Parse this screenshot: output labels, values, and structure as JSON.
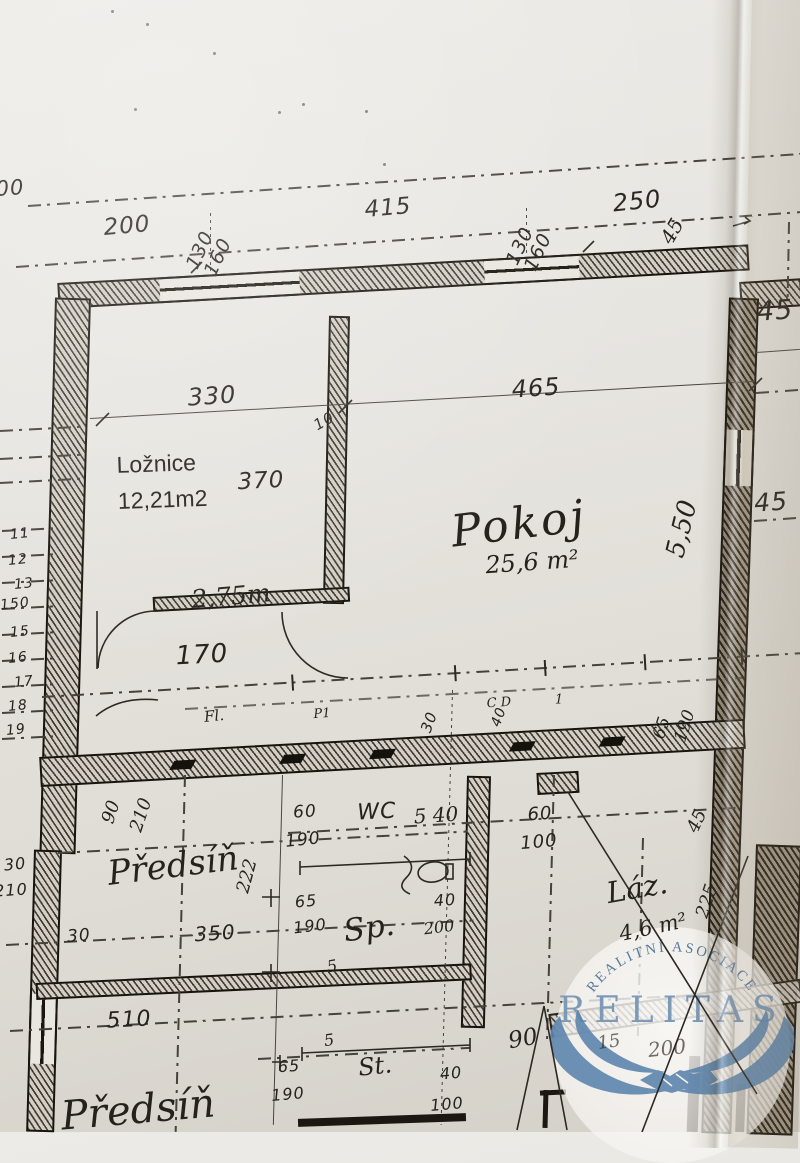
{
  "rooms": {
    "loznice": {
      "name": "Ložnice",
      "area": "12,21m2"
    },
    "pokoj": {
      "name": "Pokoj",
      "area": "25,6 m²"
    },
    "predsin": {
      "name": "Předsíň"
    },
    "wc": {
      "name": "WC"
    },
    "lazen": {
      "name": "Láz.",
      "area": "4,6 m²"
    },
    "spiz": {
      "name": "Sp."
    },
    "stoupacka": {
      "name": "St."
    }
  },
  "watermark": {
    "arc_text": "REALITNÍ ASOCIACE",
    "brand": "RELITAS",
    "logo": "handshake-wings-icon",
    "brand_color": "#7796b5",
    "logo_color": "#5d86ae"
  },
  "annotations": [
    {
      "t": "00",
      "x": 10,
      "y": 188,
      "s": 21,
      "r": -4,
      "f": "h"
    },
    {
      "t": "200",
      "x": 127,
      "y": 226,
      "s": 23,
      "r": -5,
      "f": "h"
    },
    {
      "t": "415",
      "x": 388,
      "y": 208,
      "s": 23,
      "r": -5,
      "f": "h"
    },
    {
      "t": "250",
      "x": 637,
      "y": 201,
      "s": 24,
      "r": -6,
      "f": "h"
    },
    {
      "t": "130",
      "x": 200,
      "y": 250,
      "s": 19,
      "r": -65,
      "f": "h"
    },
    {
      "t": "160",
      "x": 218,
      "y": 257,
      "s": 19,
      "r": -65,
      "f": "h"
    },
    {
      "t": "130",
      "x": 520,
      "y": 246,
      "s": 19,
      "r": -65,
      "f": "h"
    },
    {
      "t": "160",
      "x": 538,
      "y": 252,
      "s": 19,
      "r": -65,
      "f": "h"
    },
    {
      "t": "45",
      "x": 672,
      "y": 231,
      "s": 20,
      "r": -60,
      "f": "c"
    },
    {
      "t": "45",
      "x": 775,
      "y": 311,
      "s": 27,
      "r": -4,
      "f": "h"
    },
    {
      "t": "45",
      "x": 771,
      "y": 502,
      "s": 25,
      "r": -4,
      "f": "h"
    },
    {
      "t": "330",
      "x": 212,
      "y": 396,
      "s": 24,
      "r": -4,
      "f": "h"
    },
    {
      "t": "465",
      "x": 536,
      "y": 388,
      "s": 24,
      "r": -4,
      "f": "h"
    },
    {
      "t": "10",
      "x": 324,
      "y": 421,
      "s": 15,
      "r": -30,
      "f": "h"
    },
    {
      "t": "370",
      "x": 261,
      "y": 481,
      "s": 23,
      "r": -3,
      "f": "h"
    },
    {
      "t": "5,50",
      "x": 682,
      "y": 529,
      "s": 26,
      "r": -76,
      "f": "c"
    },
    {
      "t": "2,75m",
      "x": 231,
      "y": 596,
      "s": 25,
      "r": -5,
      "f": "c"
    },
    {
      "t": "170",
      "x": 202,
      "y": 655,
      "s": 26,
      "r": -3,
      "f": "h"
    },
    {
      "t": "Fl.",
      "x": 214,
      "y": 716,
      "s": 15,
      "r": -6,
      "f": "c"
    },
    {
      "t": "P1",
      "x": 322,
      "y": 714,
      "s": 13,
      "r": -4,
      "f": "c"
    },
    {
      "t": "C D",
      "x": 499,
      "y": 703,
      "s": 13,
      "r": -4,
      "f": "c"
    },
    {
      "t": "1",
      "x": 559,
      "y": 700,
      "s": 13,
      "r": 0,
      "f": "c"
    },
    {
      "t": "30",
      "x": 429,
      "y": 722,
      "s": 15,
      "r": -70,
      "f": "h"
    },
    {
      "t": "40",
      "x": 499,
      "y": 717,
      "s": 14,
      "r": -70,
      "f": "h"
    },
    {
      "t": "5 40",
      "x": 436,
      "y": 815,
      "s": 20,
      "r": -4,
      "f": "c"
    },
    {
      "t": "60",
      "x": 305,
      "y": 812,
      "s": 17,
      "r": -4,
      "f": "h"
    },
    {
      "t": "190",
      "x": 303,
      "y": 840,
      "s": 17,
      "r": -6,
      "f": "h"
    },
    {
      "t": "60",
      "x": 540,
      "y": 814,
      "s": 18,
      "r": -4,
      "f": "h"
    },
    {
      "t": "100",
      "x": 539,
      "y": 842,
      "s": 18,
      "r": -5,
      "f": "h"
    },
    {
      "t": "90",
      "x": 111,
      "y": 812,
      "s": 18,
      "r": -72,
      "f": "c"
    },
    {
      "t": "210",
      "x": 141,
      "y": 815,
      "s": 18,
      "r": -72,
      "f": "c"
    },
    {
      "t": "222",
      "x": 247,
      "y": 876,
      "s": 18,
      "r": -75,
      "f": "c"
    },
    {
      "t": "30",
      "x": 15,
      "y": 864,
      "s": 16,
      "r": -6,
      "f": "h"
    },
    {
      "t": "210",
      "x": 11,
      "y": 890,
      "s": 16,
      "r": -4,
      "f": "h"
    },
    {
      "t": "30",
      "x": 79,
      "y": 936,
      "s": 17,
      "r": -5,
      "f": "h"
    },
    {
      "t": "350",
      "x": 215,
      "y": 933,
      "s": 20,
      "r": -4,
      "f": "h"
    },
    {
      "t": "510",
      "x": 129,
      "y": 1020,
      "s": 22,
      "r": -3,
      "f": "h"
    },
    {
      "t": "5",
      "x": 332,
      "y": 966,
      "s": 16,
      "r": -10,
      "f": "c"
    },
    {
      "t": "5",
      "x": 329,
      "y": 1040,
      "s": 16,
      "r": -8,
      "f": "c"
    },
    {
      "t": "90",
      "x": 523,
      "y": 1039,
      "s": 23,
      "r": -10,
      "f": "c"
    },
    {
      "t": "65",
      "x": 306,
      "y": 901,
      "s": 16,
      "r": -5,
      "f": "h"
    },
    {
      "t": "190",
      "x": 310,
      "y": 926,
      "s": 16,
      "r": -7,
      "f": "h"
    },
    {
      "t": "40",
      "x": 445,
      "y": 900,
      "s": 16,
      "r": -4,
      "f": "h"
    },
    {
      "t": "200",
      "x": 439,
      "y": 927,
      "s": 16,
      "r": -7,
      "f": "c"
    },
    {
      "t": "65",
      "x": 289,
      "y": 1066,
      "s": 16,
      "r": -4,
      "f": "h"
    },
    {
      "t": "190",
      "x": 288,
      "y": 1094,
      "s": 16,
      "r": -5,
      "f": "h"
    },
    {
      "t": "40",
      "x": 451,
      "y": 1073,
      "s": 16,
      "r": -5,
      "f": "h"
    },
    {
      "t": "100",
      "x": 447,
      "y": 1104,
      "s": 16,
      "r": -5,
      "f": "h"
    },
    {
      "t": "65",
      "x": 662,
      "y": 728,
      "s": 17,
      "r": -72,
      "f": "c"
    },
    {
      "t": "190",
      "x": 685,
      "y": 726,
      "s": 17,
      "r": -72,
      "f": "c"
    },
    {
      "t": "45",
      "x": 697,
      "y": 821,
      "s": 18,
      "r": -65,
      "f": "c"
    },
    {
      "t": "225",
      "x": 707,
      "y": 901,
      "s": 18,
      "r": -72,
      "f": "c"
    },
    {
      "t": "15",
      "x": 609,
      "y": 1042,
      "s": 18,
      "r": -8,
      "f": "c",
      "o": 0.65
    },
    {
      "t": "200",
      "x": 667,
      "y": 1048,
      "s": 20,
      "r": -6,
      "f": "c",
      "o": 0.65
    },
    {
      "t": "11",
      "x": 20,
      "y": 534,
      "s": 14,
      "r": -6,
      "f": "h"
    },
    {
      "t": "12",
      "x": 18,
      "y": 560,
      "s": 14,
      "r": -6,
      "f": "h"
    },
    {
      "t": "13",
      "x": 24,
      "y": 584,
      "s": 14,
      "r": -6,
      "f": "h"
    },
    {
      "t": "150",
      "x": 15,
      "y": 604,
      "s": 14,
      "r": -6,
      "f": "h"
    },
    {
      "t": "15",
      "x": 20,
      "y": 632,
      "s": 14,
      "r": -6,
      "f": "h"
    },
    {
      "t": "16",
      "x": 18,
      "y": 658,
      "s": 14,
      "r": -6,
      "f": "h"
    },
    {
      "t": "17",
      "x": 24,
      "y": 682,
      "s": 14,
      "r": -6,
      "f": "h"
    },
    {
      "t": "18",
      "x": 18,
      "y": 706,
      "s": 14,
      "r": -6,
      "f": "h"
    },
    {
      "t": "19",
      "x": 16,
      "y": 730,
      "s": 14,
      "r": -6,
      "f": "h"
    }
  ]
}
